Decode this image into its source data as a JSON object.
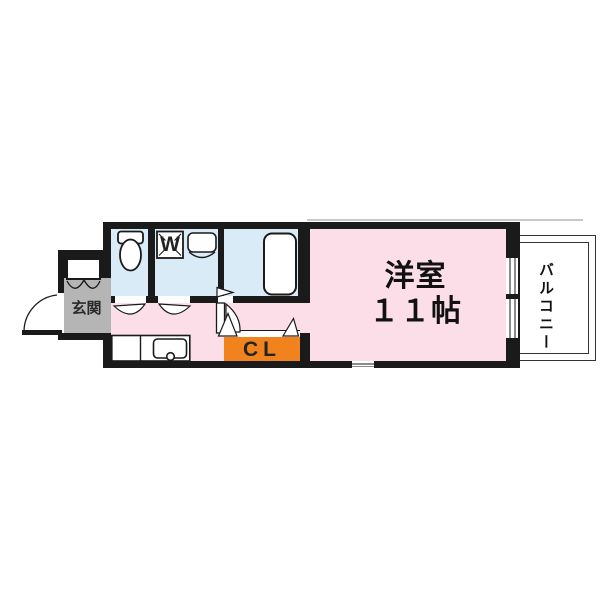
{
  "floor_plan": {
    "rooms": {
      "main_room": {
        "name": "洋室",
        "size": "１１帖"
      },
      "balcony": {
        "name": "バルコニー"
      },
      "closet": {
        "label": "CL"
      },
      "entrance": {
        "name": "玄関"
      },
      "washer_pan": {
        "label": "W"
      }
    },
    "colors": {
      "room_pink": "#FBDEE8",
      "wet_blue": "#D9EBF7",
      "closet_orange": "#F0831E",
      "entrance_gray": "#B5B5B5",
      "wall_black": "#1A1A1A"
    }
  }
}
